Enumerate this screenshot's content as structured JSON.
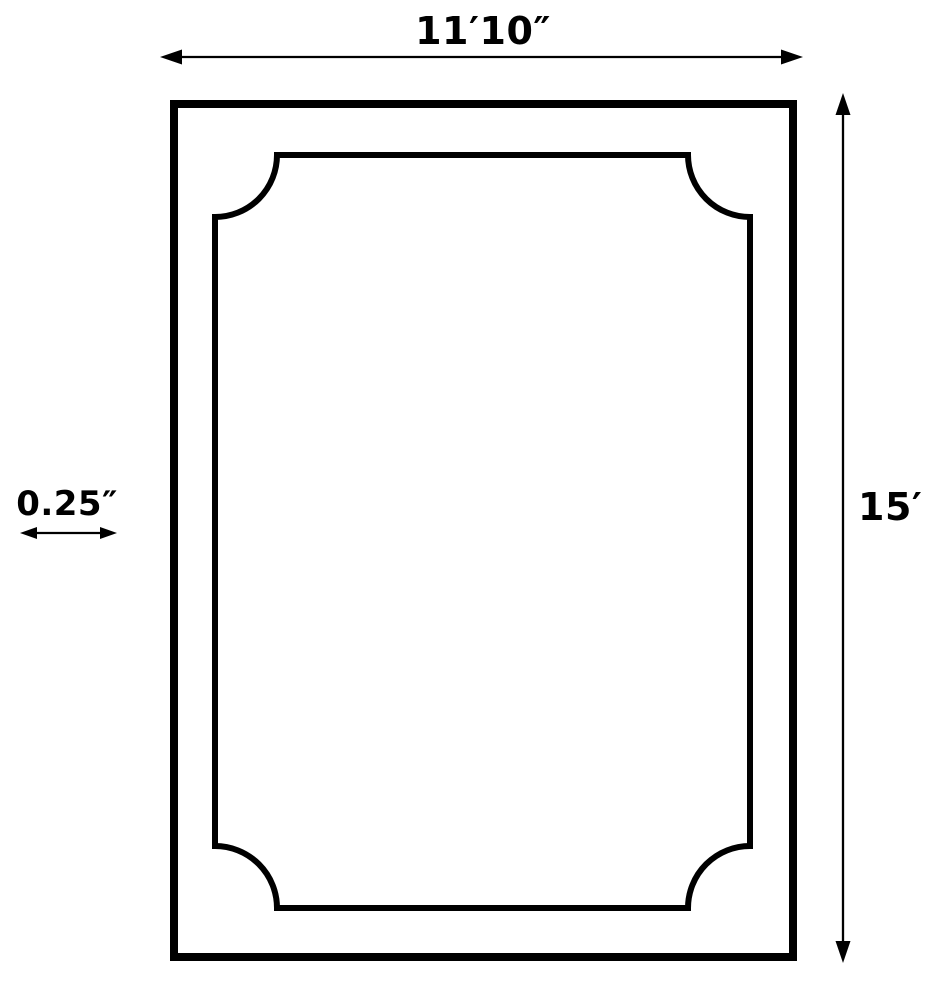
{
  "diagram": {
    "kind": "dimensioned-rectangle-drawing",
    "labels": {
      "width": "11′10″",
      "height": "15′",
      "thickness": "0.25″"
    },
    "colors": {
      "line": "#000000",
      "background": "#ffffff"
    },
    "icons": {
      "width_arrow": "horizontal-double-arrow-icon",
      "height_arrow": "vertical-double-arrow-icon",
      "thickness_arrow": "horizontal-double-arrow-icon"
    }
  }
}
